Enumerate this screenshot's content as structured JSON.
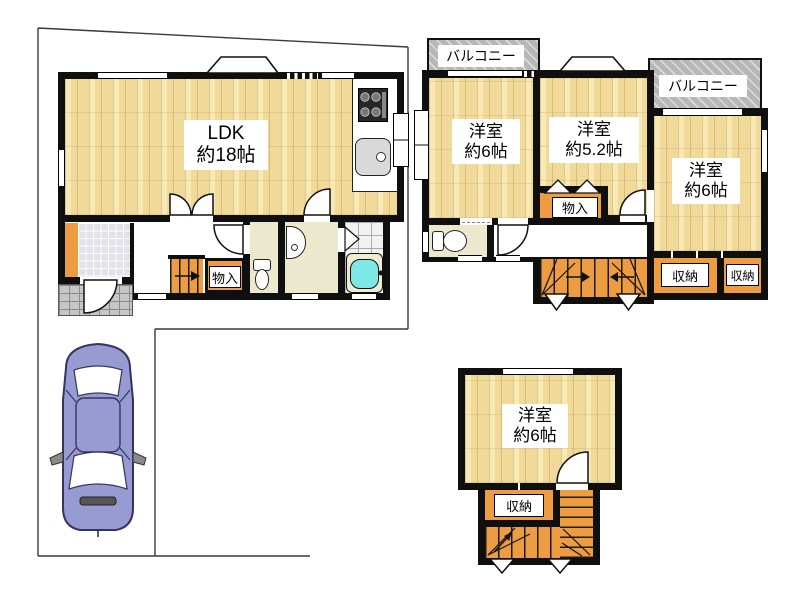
{
  "document_type": "floor-plan",
  "palette": {
    "wall": "#0f0f0f",
    "wood_floor": "#f0d999",
    "closet_orange": "#ee9c42",
    "balcony_gray": "#b7b7b7",
    "sanitary_cream": "#ebe8cd",
    "bathtub_cyan": "#7ce9e6",
    "car_purple": "#989ad2",
    "background": "#ffffff"
  },
  "labels": {
    "f1_ldk_1": "LDK",
    "f1_ldk_2": "約18帖",
    "f1_mono": "物入",
    "f2_balcony1": "バルコニー",
    "f2_balcony2": "バルコニー",
    "f2_r1_1": "洋室",
    "f2_r1_2": "約6帖",
    "f2_r2_1": "洋室",
    "f2_r2_2": "約5.2帖",
    "f2_r3_1": "洋室",
    "f2_r3_2": "約6帖",
    "f2_mono": "物入",
    "f2_shuno1": "収納",
    "f2_shuno2": "収納",
    "f3_r1_1": "洋室",
    "f3_r1_2": "約6帖",
    "f3_shuno": "収納"
  }
}
